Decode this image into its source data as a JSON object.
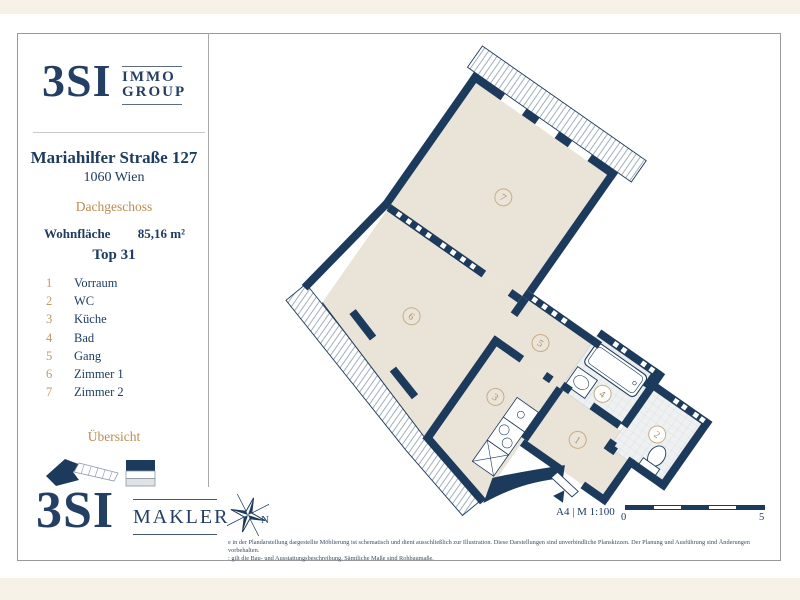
{
  "header_logo": {
    "name": "3SI",
    "sub_line1": "IMMO",
    "sub_line2": "GROUP"
  },
  "sidebar": {
    "address_line1": "Mariahilfer Straße 127",
    "address_line2": "1060 Wien",
    "floor_label": "Dachgeschoss",
    "area_label": "Wohnfläche",
    "area_value": "85,16 m²",
    "unit_label": "Top 31",
    "rooms": [
      {
        "num": "1",
        "label": "Vorraum"
      },
      {
        "num": "2",
        "label": "WC"
      },
      {
        "num": "3",
        "label": "Küche"
      },
      {
        "num": "4",
        "label": "Bad"
      },
      {
        "num": "5",
        "label": "Gang"
      },
      {
        "num": "6",
        "label": "Zimmer 1"
      },
      {
        "num": "7",
        "label": "Zimmer 2"
      }
    ],
    "overview_label": "Übersicht"
  },
  "footer_logo": {
    "name": "3SI",
    "sub": "MAKLER"
  },
  "plan": {
    "room_labels": [
      "1",
      "2",
      "3",
      "4",
      "5",
      "6",
      "7"
    ],
    "colors": {
      "wall_navy": "#1c3a5c",
      "floor_beige": "#eae3d8",
      "tile_gray": "#eef0f1",
      "accent_tan": "#bb8b51",
      "circle_stroke": "#c6ad85",
      "number_tan": "#b08f5e"
    }
  },
  "footer": {
    "compass_label": "N",
    "format_scale": "A4 | M 1:100",
    "scale_start": "0",
    "scale_end": "5",
    "disclaimer_line1": "e in der Plandarstellung dargestellte Möblierung ist schematisch und dient ausschließlich zur Illustration. Diese Darstellungen sind unverbindliche Planskizzen. Der Planung und Ausführung sind Änderungen vorbehalten.",
    "disclaimer_line2": ": gilt die Bau- und Ausstattungsbeschreibung. Sämtliche Maße sind Rohbaumaße."
  }
}
